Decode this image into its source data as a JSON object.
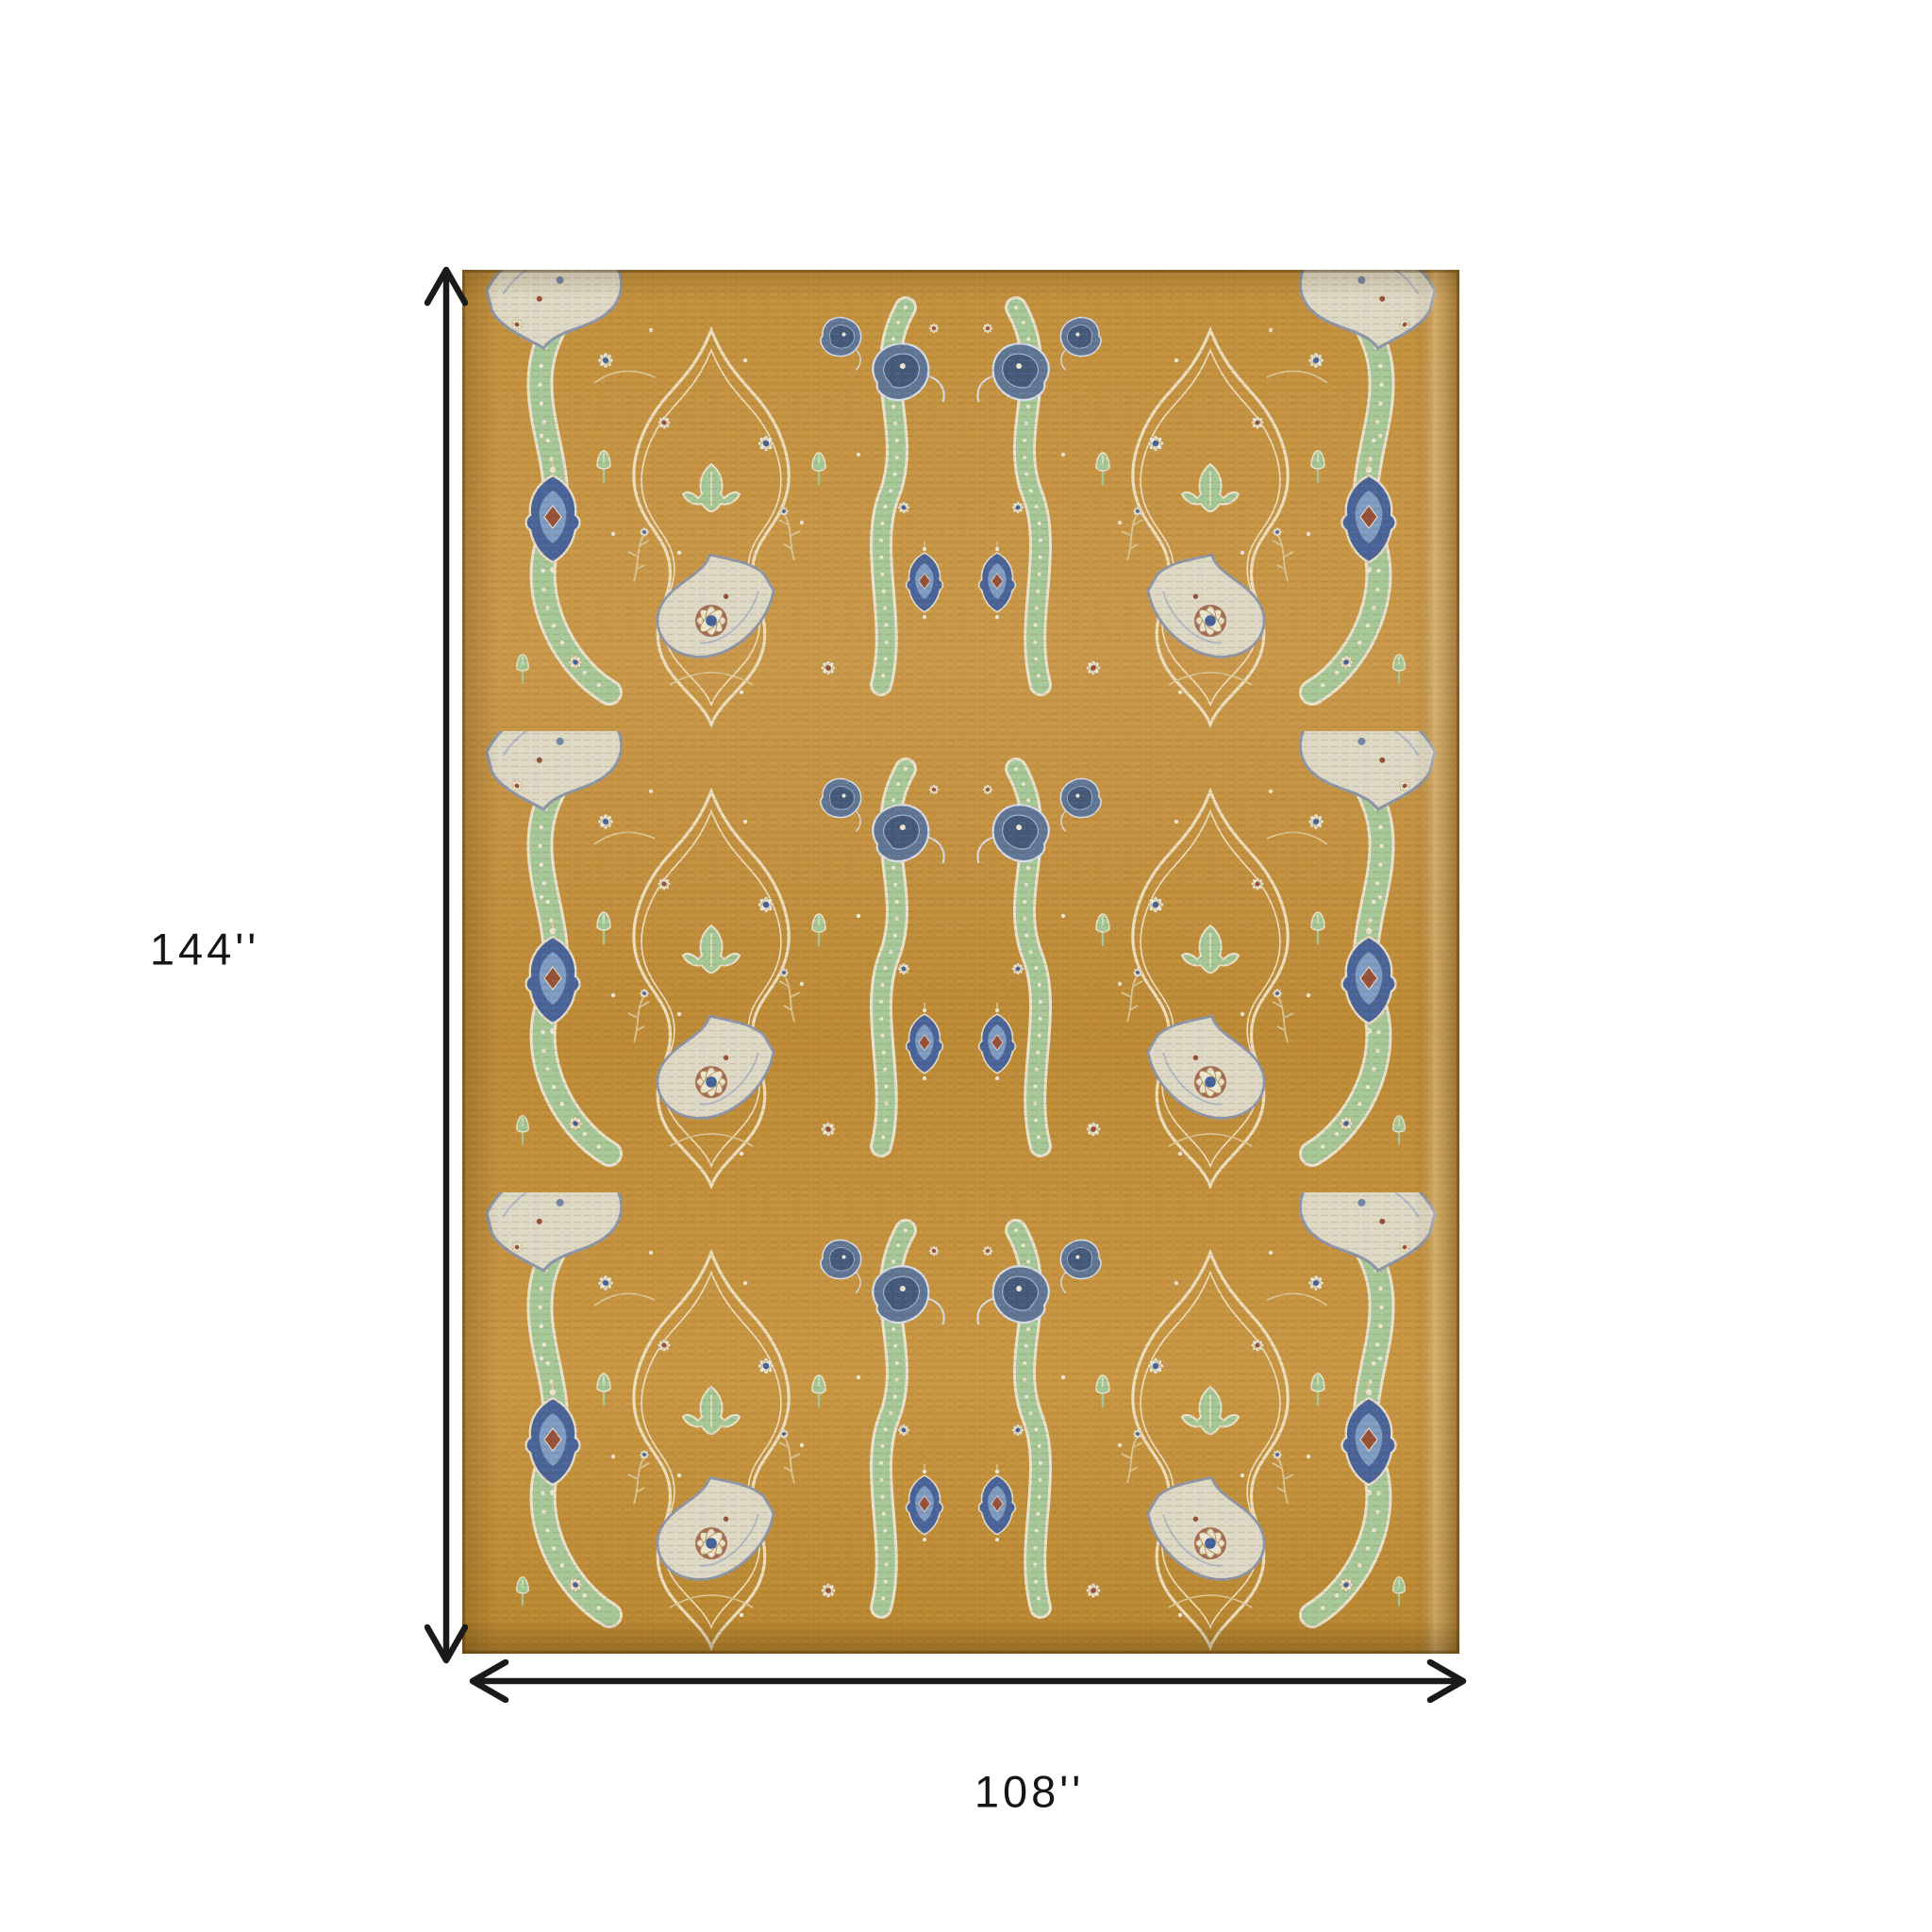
{
  "figure": {
    "background_color": "#ffffff",
    "subject": "gold oriental area rug with dimension arrows"
  },
  "dimensions": {
    "height": {
      "label": "144''"
    },
    "width": {
      "label": "108''"
    },
    "arrow_color": "#1a1a1a",
    "label_color": "#161616"
  },
  "rug": {
    "palette": {
      "ground_gold": "#c4923e",
      "ground_gold_dark": "#b07f33",
      "cream": "#ece6d4",
      "ivory_leaf": "#ded9c7",
      "slate_blue": "#5f7596",
      "deep_blue": "#43597c",
      "light_blue": "#7e9cc4",
      "sage_green": "#a6c898",
      "rust": "#96503a"
    }
  }
}
